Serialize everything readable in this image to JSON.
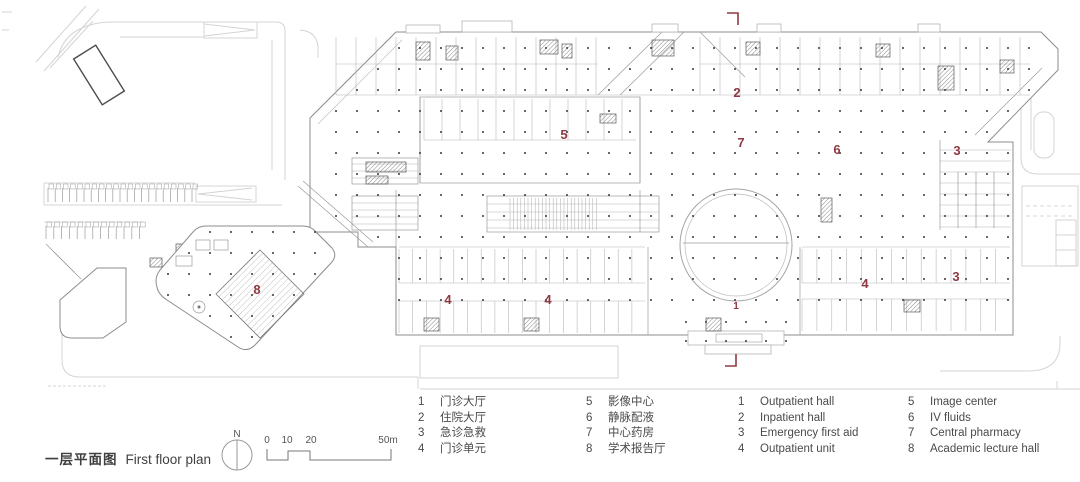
{
  "title": {
    "zh": "一层平面图",
    "en": "First floor plan"
  },
  "compass": {
    "label": "N"
  },
  "scale_bar": {
    "ticks": [
      "0",
      "10",
      "20",
      "50m"
    ]
  },
  "legend": {
    "zh": [
      {
        "num": "1",
        "label": "门诊大厅"
      },
      {
        "num": "2",
        "label": "住院大厅"
      },
      {
        "num": "3",
        "label": "急诊急救"
      },
      {
        "num": "4",
        "label": "门诊单元"
      },
      {
        "num": "5",
        "label": "影像中心"
      },
      {
        "num": "6",
        "label": "静脉配液"
      },
      {
        "num": "7",
        "label": "中心药房"
      },
      {
        "num": "8",
        "label": "学术报告厅"
      }
    ],
    "en": [
      {
        "num": "1",
        "label": "Outpatient hall"
      },
      {
        "num": "2",
        "label": "Inpatient hall"
      },
      {
        "num": "3",
        "label": "Emergency first aid"
      },
      {
        "num": "4",
        "label": "Outpatient unit"
      },
      {
        "num": "5",
        "label": "Image center"
      },
      {
        "num": "6",
        "label": "IV fluids"
      },
      {
        "num": "7",
        "label": "Central pharmacy"
      },
      {
        "num": "8",
        "label": "Academic lecture hall"
      }
    ]
  },
  "plan": {
    "markers": [
      {
        "label": "2"
      },
      {
        "label": "7"
      },
      {
        "label": "5"
      },
      {
        "label": "6"
      },
      {
        "label": "3"
      },
      {
        "label": "3"
      },
      {
        "label": "4"
      },
      {
        "label": "4"
      },
      {
        "label": "4"
      },
      {
        "label": "8"
      },
      {
        "label": "1"
      }
    ]
  },
  "colors": {
    "accent_red": "#8f3a42",
    "wall_gray": "#8c8c8c",
    "road_gray": "#d4d4d4"
  }
}
